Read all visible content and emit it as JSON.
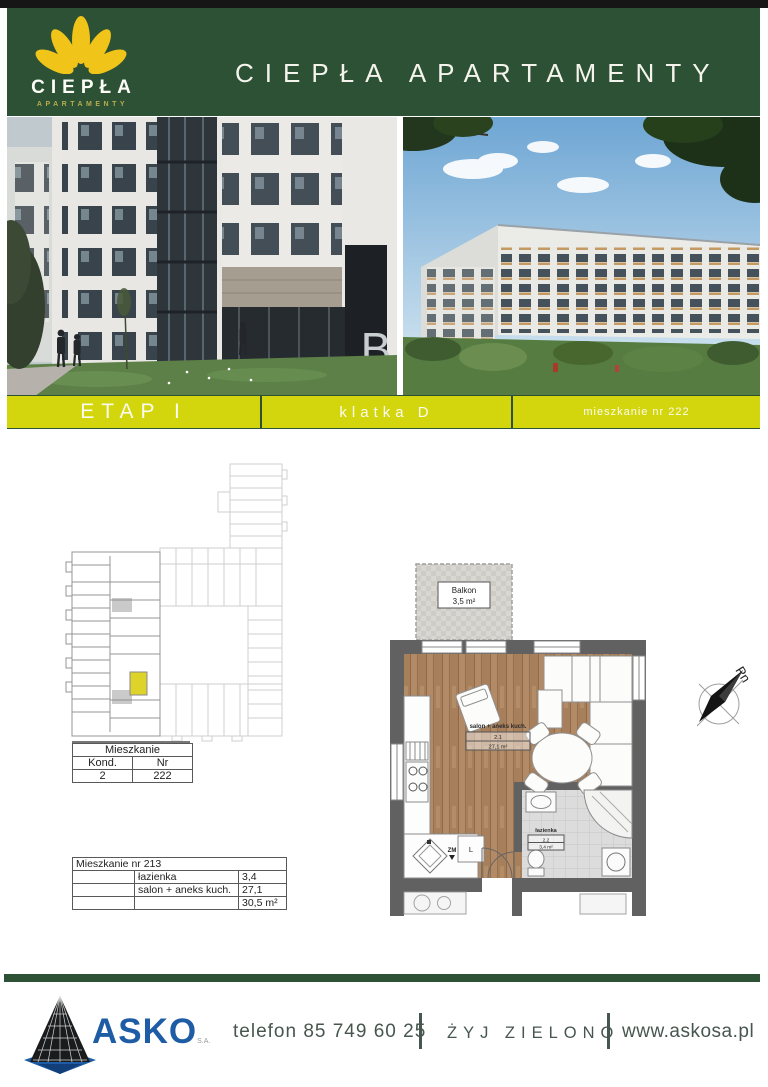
{
  "header": {
    "logo_name": "CIEPŁA",
    "logo_subtitle": "APARTAMENTY",
    "title": "CIEPŁA APARTAMENTY"
  },
  "banner": {
    "stage": "ETAP I",
    "staircase": "klatka D",
    "apartment": "mieszkanie nr 222"
  },
  "photos": {
    "left_sign": "B"
  },
  "unit_table": {
    "title": "Mieszkanie",
    "headers": [
      "Kond.",
      "Nr"
    ],
    "values": [
      "2",
      "222"
    ]
  },
  "area_table": {
    "title": "Mieszkanie nr 213",
    "rows": [
      {
        "room": "łazienka",
        "area": "3,4"
      },
      {
        "room": "salon + aneks kuch.",
        "area": "27,1"
      },
      {
        "room": "",
        "area": "30,5 m²"
      }
    ]
  },
  "floorplan": {
    "balcony_name": "Balkon",
    "balcony_area": "3,5 m²",
    "living_name": "salon + aneks kuch.",
    "living_no": "2.1",
    "living_area": "27,1 m²",
    "bath_name": "łazienka",
    "bath_no": "2.2",
    "bath_area": "3,4 m²",
    "dishwasher_label": "ZM",
    "fridge_label": "L",
    "compass_label": "Pn"
  },
  "footer": {
    "brand": "ASKO",
    "brand_suffix": "S.A.",
    "phone": "telefon 85 749 60 25",
    "slogan": "ŻYJ ZIELONO",
    "website": "www.askosa.pl"
  },
  "colors": {
    "brand_green": "#2d5134",
    "banner_yellow": "#d3d60d",
    "logo_yellow": "#f0c419",
    "asko_blue": "#1e5ca6",
    "unit_highlight": "#ded32a"
  }
}
